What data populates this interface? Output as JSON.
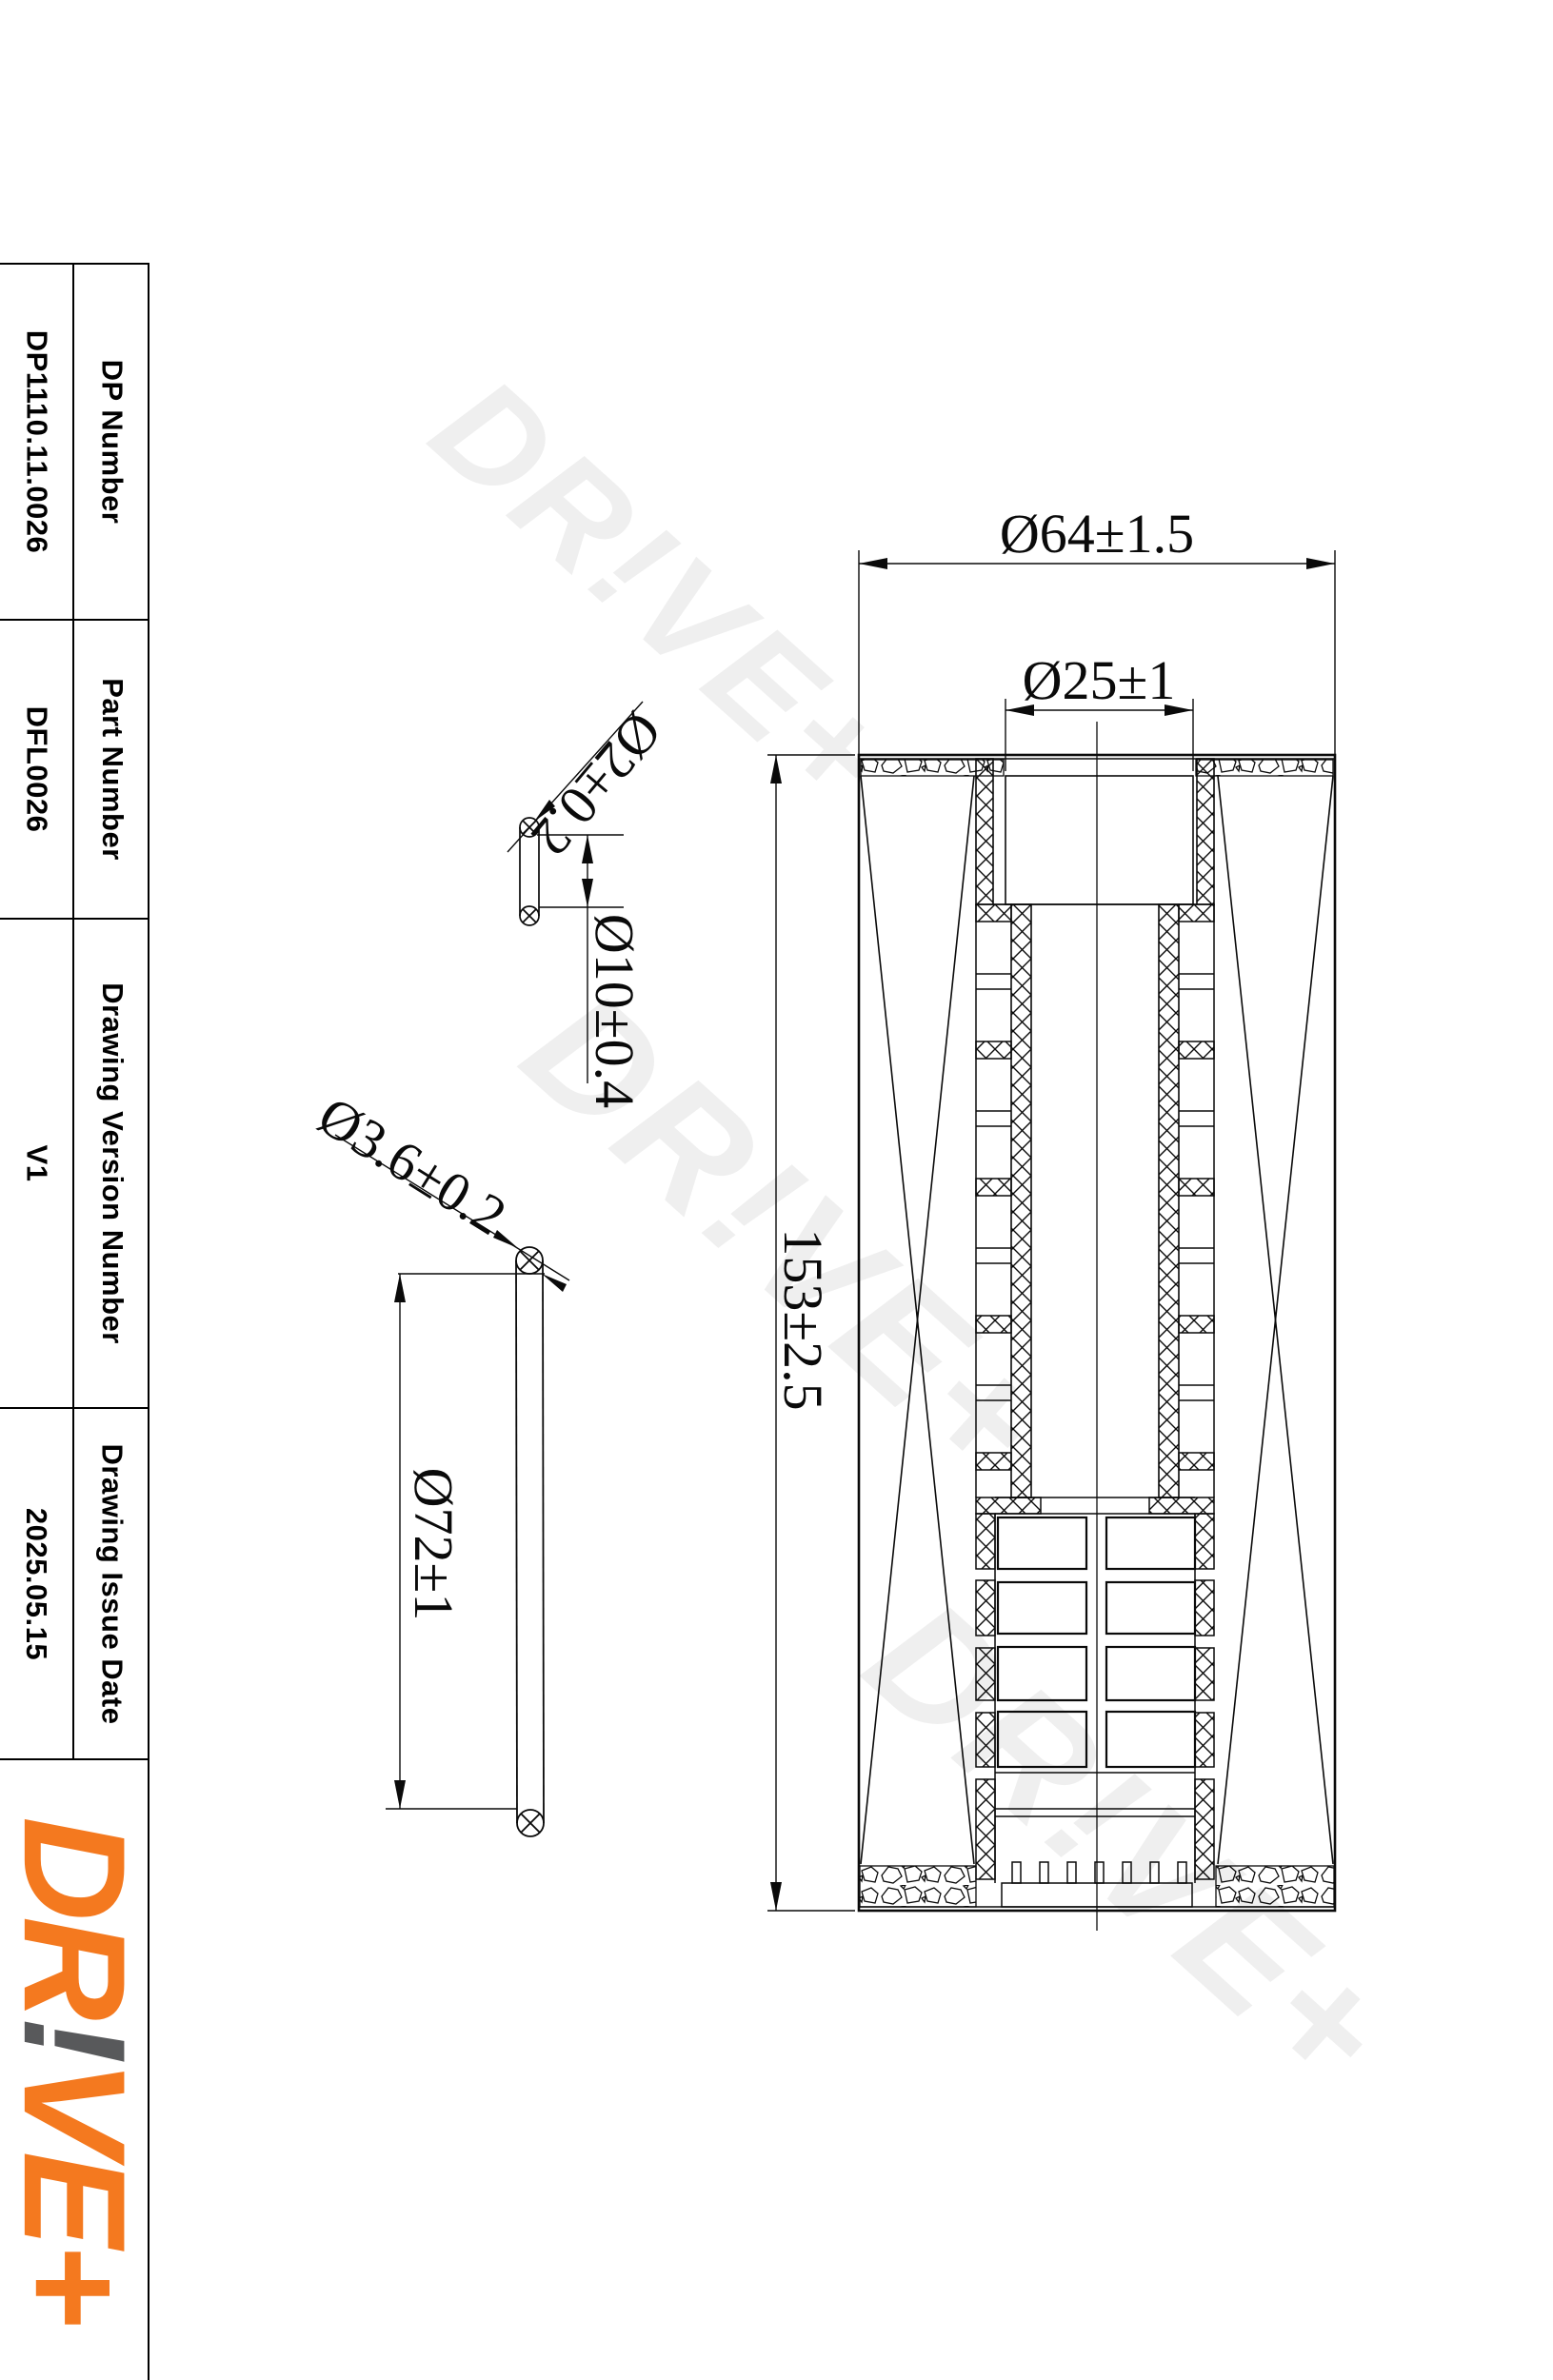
{
  "title_block": {
    "rows": [
      {
        "label": "DP Number",
        "value": "DP1110.11.0026"
      },
      {
        "label": "Part Number",
        "value": "DFL0026"
      },
      {
        "label": "Drawing Version Number",
        "value": "V1"
      },
      {
        "label": "Drawing Issue Date",
        "value": "2025.05.15"
      }
    ]
  },
  "logo": {
    "dr": "DR",
    "bang": "!",
    "veplus": "VE+"
  },
  "watermark": {
    "text": "DR!VE+"
  },
  "dimensions": {
    "outer_diameter": "Ø64±1.5",
    "inner_diameter": "Ø25±1",
    "total_height": "153±2.5",
    "small_oring_cord": "Ø2±0.2",
    "small_oring_diameter": "Ø10±0.4",
    "large_oring_cord": "Ø3.6±0.2",
    "large_oring_diameter": "Ø72±1"
  },
  "colors": {
    "brand_orange": "#F4791F",
    "brand_gray": "#58595B",
    "watermark_gray": "#EFEFEF",
    "line_black": "#0A0A0A"
  }
}
